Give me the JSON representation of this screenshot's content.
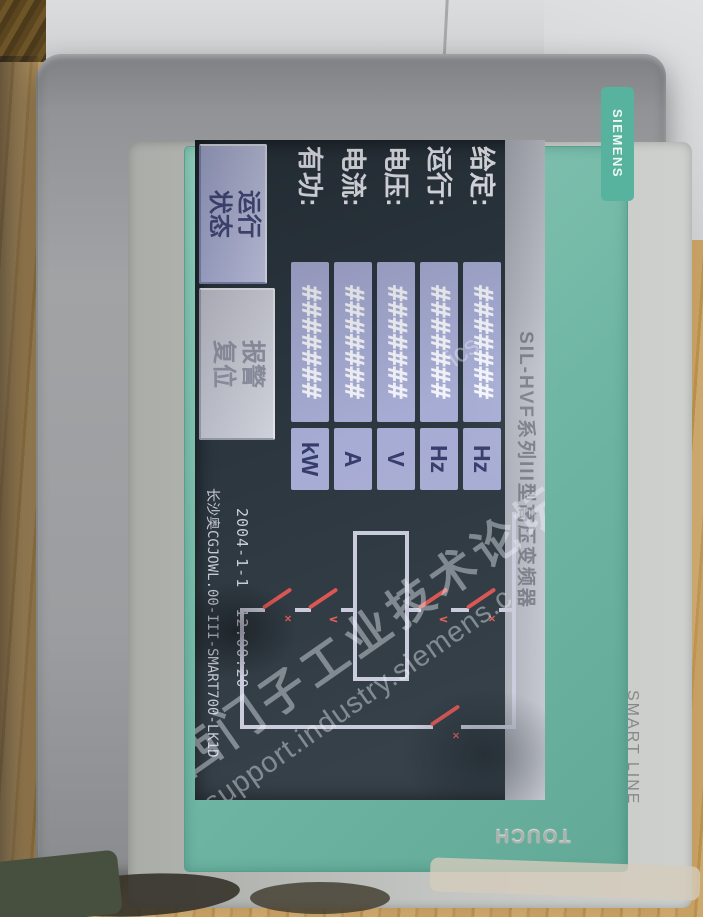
{
  "device": {
    "brand": "SIEMENS",
    "series": "SMART LINE",
    "touch": "TOUCH"
  },
  "watermark": {
    "cn": "西门子工业技术论坛",
    "en": "support.industry.siemens.c",
    "frag": "ics"
  },
  "hmi": {
    "title": "SIL-HVF系列III型高压变频器",
    "rows": [
      {
        "label": "给定:",
        "value": "#######",
        "unit": "Hz"
      },
      {
        "label": "运行:",
        "value": "#######",
        "unit": "Hz"
      },
      {
        "label": "电压:",
        "value": "#######",
        "unit": "V"
      },
      {
        "label": "电流:",
        "value": "#######",
        "unit": "A"
      },
      {
        "label": "有功:",
        "value": "#######",
        "unit": "kW"
      }
    ],
    "buttons": [
      {
        "label": "运行状态"
      },
      {
        "label": "报警复位"
      }
    ],
    "datetime": "2004-1-1  12:00:20",
    "program_id": "长沙奥CGJOWL.00-III-SMART700-LK1D",
    "diagram": {
      "switch_marks": [
        "×",
        "∨",
        "∨",
        "×",
        "×"
      ]
    },
    "colors": {
      "field_bg": "#a7acd4",
      "wire": "#c9cbdc",
      "switch_red": "#d9534f",
      "screen_bg": "#2c3740",
      "bezel_teal": "#6db4a2"
    }
  }
}
